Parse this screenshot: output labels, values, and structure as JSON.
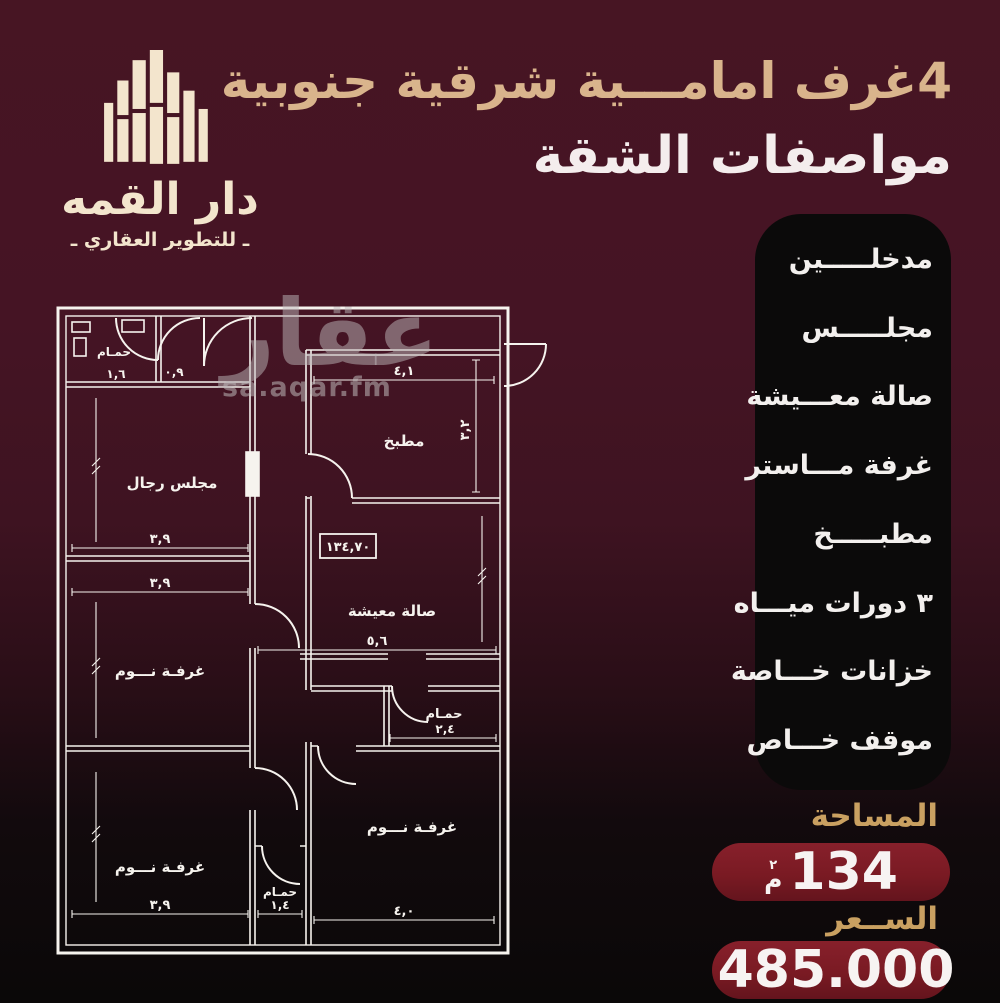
{
  "colors": {
    "background_top": "#471523",
    "background_bottom": "#0a0808",
    "title_gold": "#d9b48c",
    "label_gold": "#c9a061",
    "panel_black": "#0b0a0a",
    "pill_red": "#7a1a23",
    "plan_line": "#f6f3ee",
    "logo_cream": "#f3e5cd"
  },
  "logo": {
    "icon": "building-skyline-icon",
    "name": "دار القمه",
    "tagline": "ـ للتطوير العقاري ـ"
  },
  "header": {
    "title_line1": "4غرف امامـــية شرقية جنوبية",
    "title_line2": "مواصفات الشقة"
  },
  "features": {
    "items": [
      "مدخلـــــين",
      "مجلـــــس",
      "صالة معـــيشة",
      "غرفة مـــاستر",
      "مطبـــــخ",
      "٣ دورات ميـــاه",
      "خزانات خـــاصة",
      "موقف خـــاص"
    ]
  },
  "watermark": {
    "big": "عقار",
    "small": "sa.aqar.fm"
  },
  "summary": {
    "area_label": "المساحة",
    "area_value": "134",
    "area_unit_letter": "م",
    "area_unit_sup": "٢",
    "price_label": "الســعر",
    "price_value": "485.000",
    "currency": "riyal-symbol"
  },
  "floorplan": {
    "area_box_value": "١٣٤,٧٠",
    "labels": {
      "bath_top_left": "حمـام",
      "majlis": "مجلس رجال",
      "bed_left_mid": "غرفـة نـــوم",
      "bed_left_bottom": "غرفـة نـــوم",
      "kitchen": "مطبخ",
      "living": "صالة معيشة",
      "bath_mid": "حمـام",
      "bed_right_bottom": "غرفـة نـــوم",
      "bath_bottom": "حمـام"
    },
    "dims": {
      "bath_tl_w": "١,٦",
      "bath_tl_h": "٠,٩",
      "majlis_w": "٣,٩",
      "bed2_w": "٣,٩",
      "bed3_w": "٣,٩",
      "kitchen_w": "٤,١",
      "kitchen_h": "٣,٢",
      "living_w": "٥,٦",
      "bath_mid_w": "٢,٤",
      "bed4_w": "٤,٠",
      "bath_bottom_w": "١,٤"
    }
  }
}
